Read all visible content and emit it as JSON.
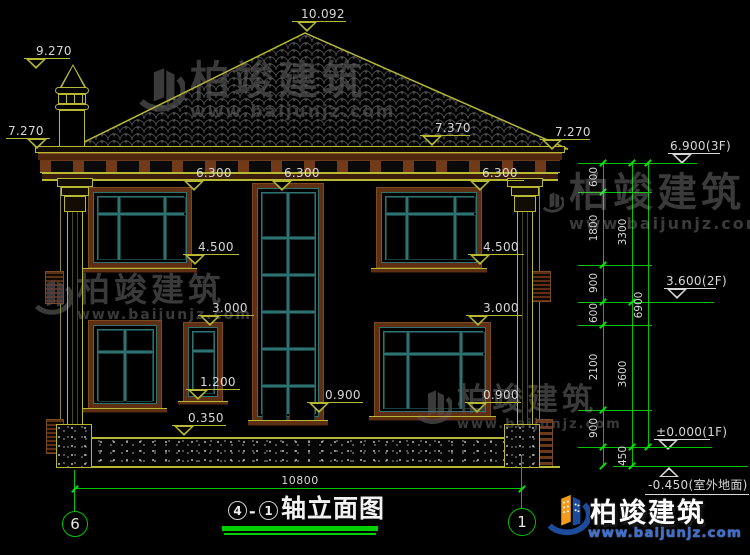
{
  "brand": {
    "name": "柏竣建筑",
    "url": "www.baijunjz.com"
  },
  "title_block": {
    "axis_left": "4",
    "separator": "-",
    "axis_right": "1",
    "title": "轴立面图"
  },
  "axis_bubbles": {
    "left": "6",
    "right": "1"
  },
  "bottom_dimension": {
    "label": "10800"
  },
  "colors": {
    "line_yellow": "#b8b832",
    "line_green": "#00c400",
    "tick_green": "#00e400",
    "frame_teal": "#2e7272",
    "frame_brown": "#5f2f14",
    "text_white": "#d8d8d8",
    "watermark_gray": "#3f3f3f",
    "logo_blue": "#1d4c9c",
    "logo_orange": "#f29b1d"
  },
  "elevation_markers": [
    {
      "text": "10.092",
      "tx": 301,
      "ty": 8,
      "lx": 292,
      "ly": 21,
      "lw": 54,
      "trx": 297,
      "try": 22,
      "dir": "down",
      "c": "y"
    },
    {
      "text": "9.270",
      "tx": 36,
      "ty": 45,
      "lx": 24,
      "ly": 58,
      "lw": 46,
      "trx": 26,
      "try": 59,
      "dir": "down",
      "c": "y"
    },
    {
      "text": "7.270",
      "tx": 8,
      "ty": 125,
      "lx": 6,
      "ly": 138,
      "lw": 44,
      "trx": 27,
      "try": 139,
      "dir": "down",
      "c": "y"
    },
    {
      "text": "7.370",
      "tx": 435,
      "ty": 122,
      "lx": 420,
      "ly": 135,
      "lw": 50,
      "trx": 422,
      "try": 136,
      "dir": "down",
      "c": "y"
    },
    {
      "text": "7.270",
      "tx": 555,
      "ty": 126,
      "lx": 540,
      "ly": 139,
      "lw": 50,
      "trx": 542,
      "try": 140,
      "dir": "down",
      "c": "y"
    },
    {
      "text": "6.300",
      "tx": 196,
      "ty": 167,
      "lx": 182,
      "ly": 180,
      "lw": 56,
      "trx": 184,
      "try": 181,
      "dir": "down",
      "c": "y"
    },
    {
      "text": "6.300",
      "tx": 284,
      "ty": 167,
      "lx": 270,
      "ly": 180,
      "lw": 56,
      "trx": 272,
      "try": 181,
      "dir": "down",
      "c": "y"
    },
    {
      "text": "6.300",
      "tx": 482,
      "ty": 167,
      "lx": 468,
      "ly": 180,
      "lw": 56,
      "trx": 470,
      "try": 181,
      "dir": "down",
      "c": "y"
    },
    {
      "text": "4.500",
      "tx": 198,
      "ty": 241,
      "lx": 183,
      "ly": 254,
      "lw": 56,
      "trx": 185,
      "try": 255,
      "dir": "down",
      "c": "y"
    },
    {
      "text": "4.500",
      "tx": 483,
      "ty": 241,
      "lx": 468,
      "ly": 254,
      "lw": 56,
      "trx": 470,
      "try": 255,
      "dir": "down",
      "c": "y"
    },
    {
      "text": "3.000",
      "tx": 212,
      "ty": 302,
      "lx": 198,
      "ly": 315,
      "lw": 56,
      "trx": 200,
      "try": 316,
      "dir": "down",
      "c": "y"
    },
    {
      "text": "3.000",
      "tx": 483,
      "ty": 302,
      "lx": 466,
      "ly": 315,
      "lw": 56,
      "trx": 468,
      "try": 316,
      "dir": "down",
      "c": "y"
    },
    {
      "text": "1.200",
      "tx": 200,
      "ty": 376,
      "lx": 186,
      "ly": 389,
      "lw": 54,
      "trx": 188,
      "try": 390,
      "dir": "down",
      "c": "y"
    },
    {
      "text": "0.900",
      "tx": 325,
      "ty": 389,
      "lx": 307,
      "ly": 402,
      "lw": 56,
      "trx": 309,
      "try": 403,
      "dir": "down",
      "c": "y"
    },
    {
      "text": "0.900",
      "tx": 483,
      "ty": 389,
      "lx": 465,
      "ly": 402,
      "lw": 56,
      "trx": 467,
      "try": 403,
      "dir": "down",
      "c": "y"
    },
    {
      "text": "0.350",
      "tx": 188,
      "ty": 412,
      "lx": 172,
      "ly": 425,
      "lw": 54,
      "trx": 174,
      "try": 426,
      "dir": "down",
      "c": "y"
    },
    {
      "text": "6.900(3F)",
      "tx": 670,
      "ty": 140,
      "lx": 668,
      "ly": 153,
      "lw": 52,
      "trx": 672,
      "try": 154,
      "dir": "down",
      "c": "w"
    },
    {
      "text": "3.600(2F)",
      "tx": 666,
      "ty": 275,
      "lx": 664,
      "ly": 288,
      "lw": 52,
      "trx": 667,
      "try": 289,
      "dir": "down",
      "c": "w"
    },
    {
      "text": "±0.000(1F)",
      "tx": 656,
      "ty": 426,
      "lx": 654,
      "ly": 439,
      "lw": 56,
      "trx": 658,
      "try": 440,
      "dir": "down",
      "c": "w"
    },
    {
      "text": "-0.450(室外地面)",
      "tx": 648,
      "ty": 479,
      "lx": 645,
      "ly": 494,
      "lw": 104,
      "trx": 659,
      "try": 467,
      "dir": "up",
      "c": "w"
    }
  ],
  "right_dimensions": {
    "levels": [
      {
        "y": 163,
        "x1": 578,
        "x2": 697
      },
      {
        "y": 192,
        "x1": 578,
        "x2": 652
      },
      {
        "y": 265,
        "x1": 578,
        "x2": 652
      },
      {
        "y": 302,
        "x1": 578,
        "x2": 714
      },
      {
        "y": 325,
        "x1": 578,
        "x2": 652
      },
      {
        "y": 410,
        "x1": 578,
        "x2": 652
      },
      {
        "y": 447,
        "x1": 578,
        "x2": 712
      },
      {
        "y": 466,
        "x1": 613,
        "x2": 748
      }
    ],
    "verticals": [
      {
        "x": 603,
        "y1": 163,
        "y2": 466
      },
      {
        "x": 632,
        "y1": 163,
        "y2": 466
      },
      {
        "x": 648,
        "y1": 163,
        "y2": 447
      }
    ],
    "ticks": [
      {
        "x": 603,
        "y": 163
      },
      {
        "x": 603,
        "y": 192
      },
      {
        "x": 603,
        "y": 265
      },
      {
        "x": 603,
        "y": 302
      },
      {
        "x": 603,
        "y": 325
      },
      {
        "x": 603,
        "y": 410
      },
      {
        "x": 603,
        "y": 447
      },
      {
        "x": 603,
        "y": 466
      },
      {
        "x": 632,
        "y": 163
      },
      {
        "x": 632,
        "y": 302
      },
      {
        "x": 632,
        "y": 447
      },
      {
        "x": 632,
        "y": 466
      },
      {
        "x": 648,
        "y": 163
      },
      {
        "x": 648,
        "y": 447
      },
      {
        "x": 75,
        "y": 489
      },
      {
        "x": 522,
        "y": 489
      }
    ],
    "chain_labels": [
      {
        "t": "600",
        "x": 594,
        "y": 177
      },
      {
        "t": "1800",
        "x": 594,
        "y": 228
      },
      {
        "t": "900",
        "x": 594,
        "y": 283
      },
      {
        "t": "600",
        "x": 594,
        "y": 313
      },
      {
        "t": "2100",
        "x": 594,
        "y": 367
      },
      {
        "t": "900",
        "x": 594,
        "y": 428
      },
      {
        "t": "3300",
        "x": 623,
        "y": 232
      },
      {
        "t": "3600",
        "x": 623,
        "y": 374
      },
      {
        "t": "450",
        "x": 623,
        "y": 456
      },
      {
        "t": "6900",
        "x": 639,
        "y": 305
      }
    ]
  }
}
